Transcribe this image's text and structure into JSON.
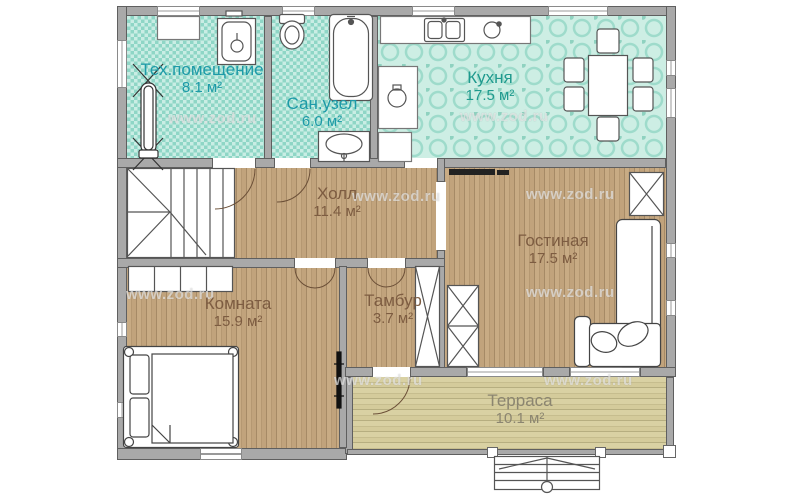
{
  "plan": {
    "title": "floor-plan",
    "watermark": "www.zod.ru",
    "rooms": [
      {
        "name": "Тех.помещение",
        "area": "8.1 м²"
      },
      {
        "name": "Сан.узел",
        "area": "6.0 м²"
      },
      {
        "name": "Кухня",
        "area": "17.5 м²"
      },
      {
        "name": "Холл",
        "area": "11.4 м²"
      },
      {
        "name": "Гостиная",
        "area": "17.5 м²"
      },
      {
        "name": "Комната",
        "area": "15.9 м²"
      },
      {
        "name": "Тамбур",
        "area": "3.7 м²"
      },
      {
        "name": "Терраса",
        "area": "10.1 м²"
      }
    ],
    "colors": {
      "wall": "#a9a9a9",
      "tech_room_floor": "#8fd6c6",
      "kitchen_floor": "#cdeee4",
      "wood_floor": "#bfa27b",
      "terrace_floor": "#d6cd9d",
      "teal_label": "#1d9aa8",
      "kitchen_label": "#1f9a8e",
      "wood_label": "#7d5c41",
      "terrace_label": "#8b8570"
    }
  }
}
